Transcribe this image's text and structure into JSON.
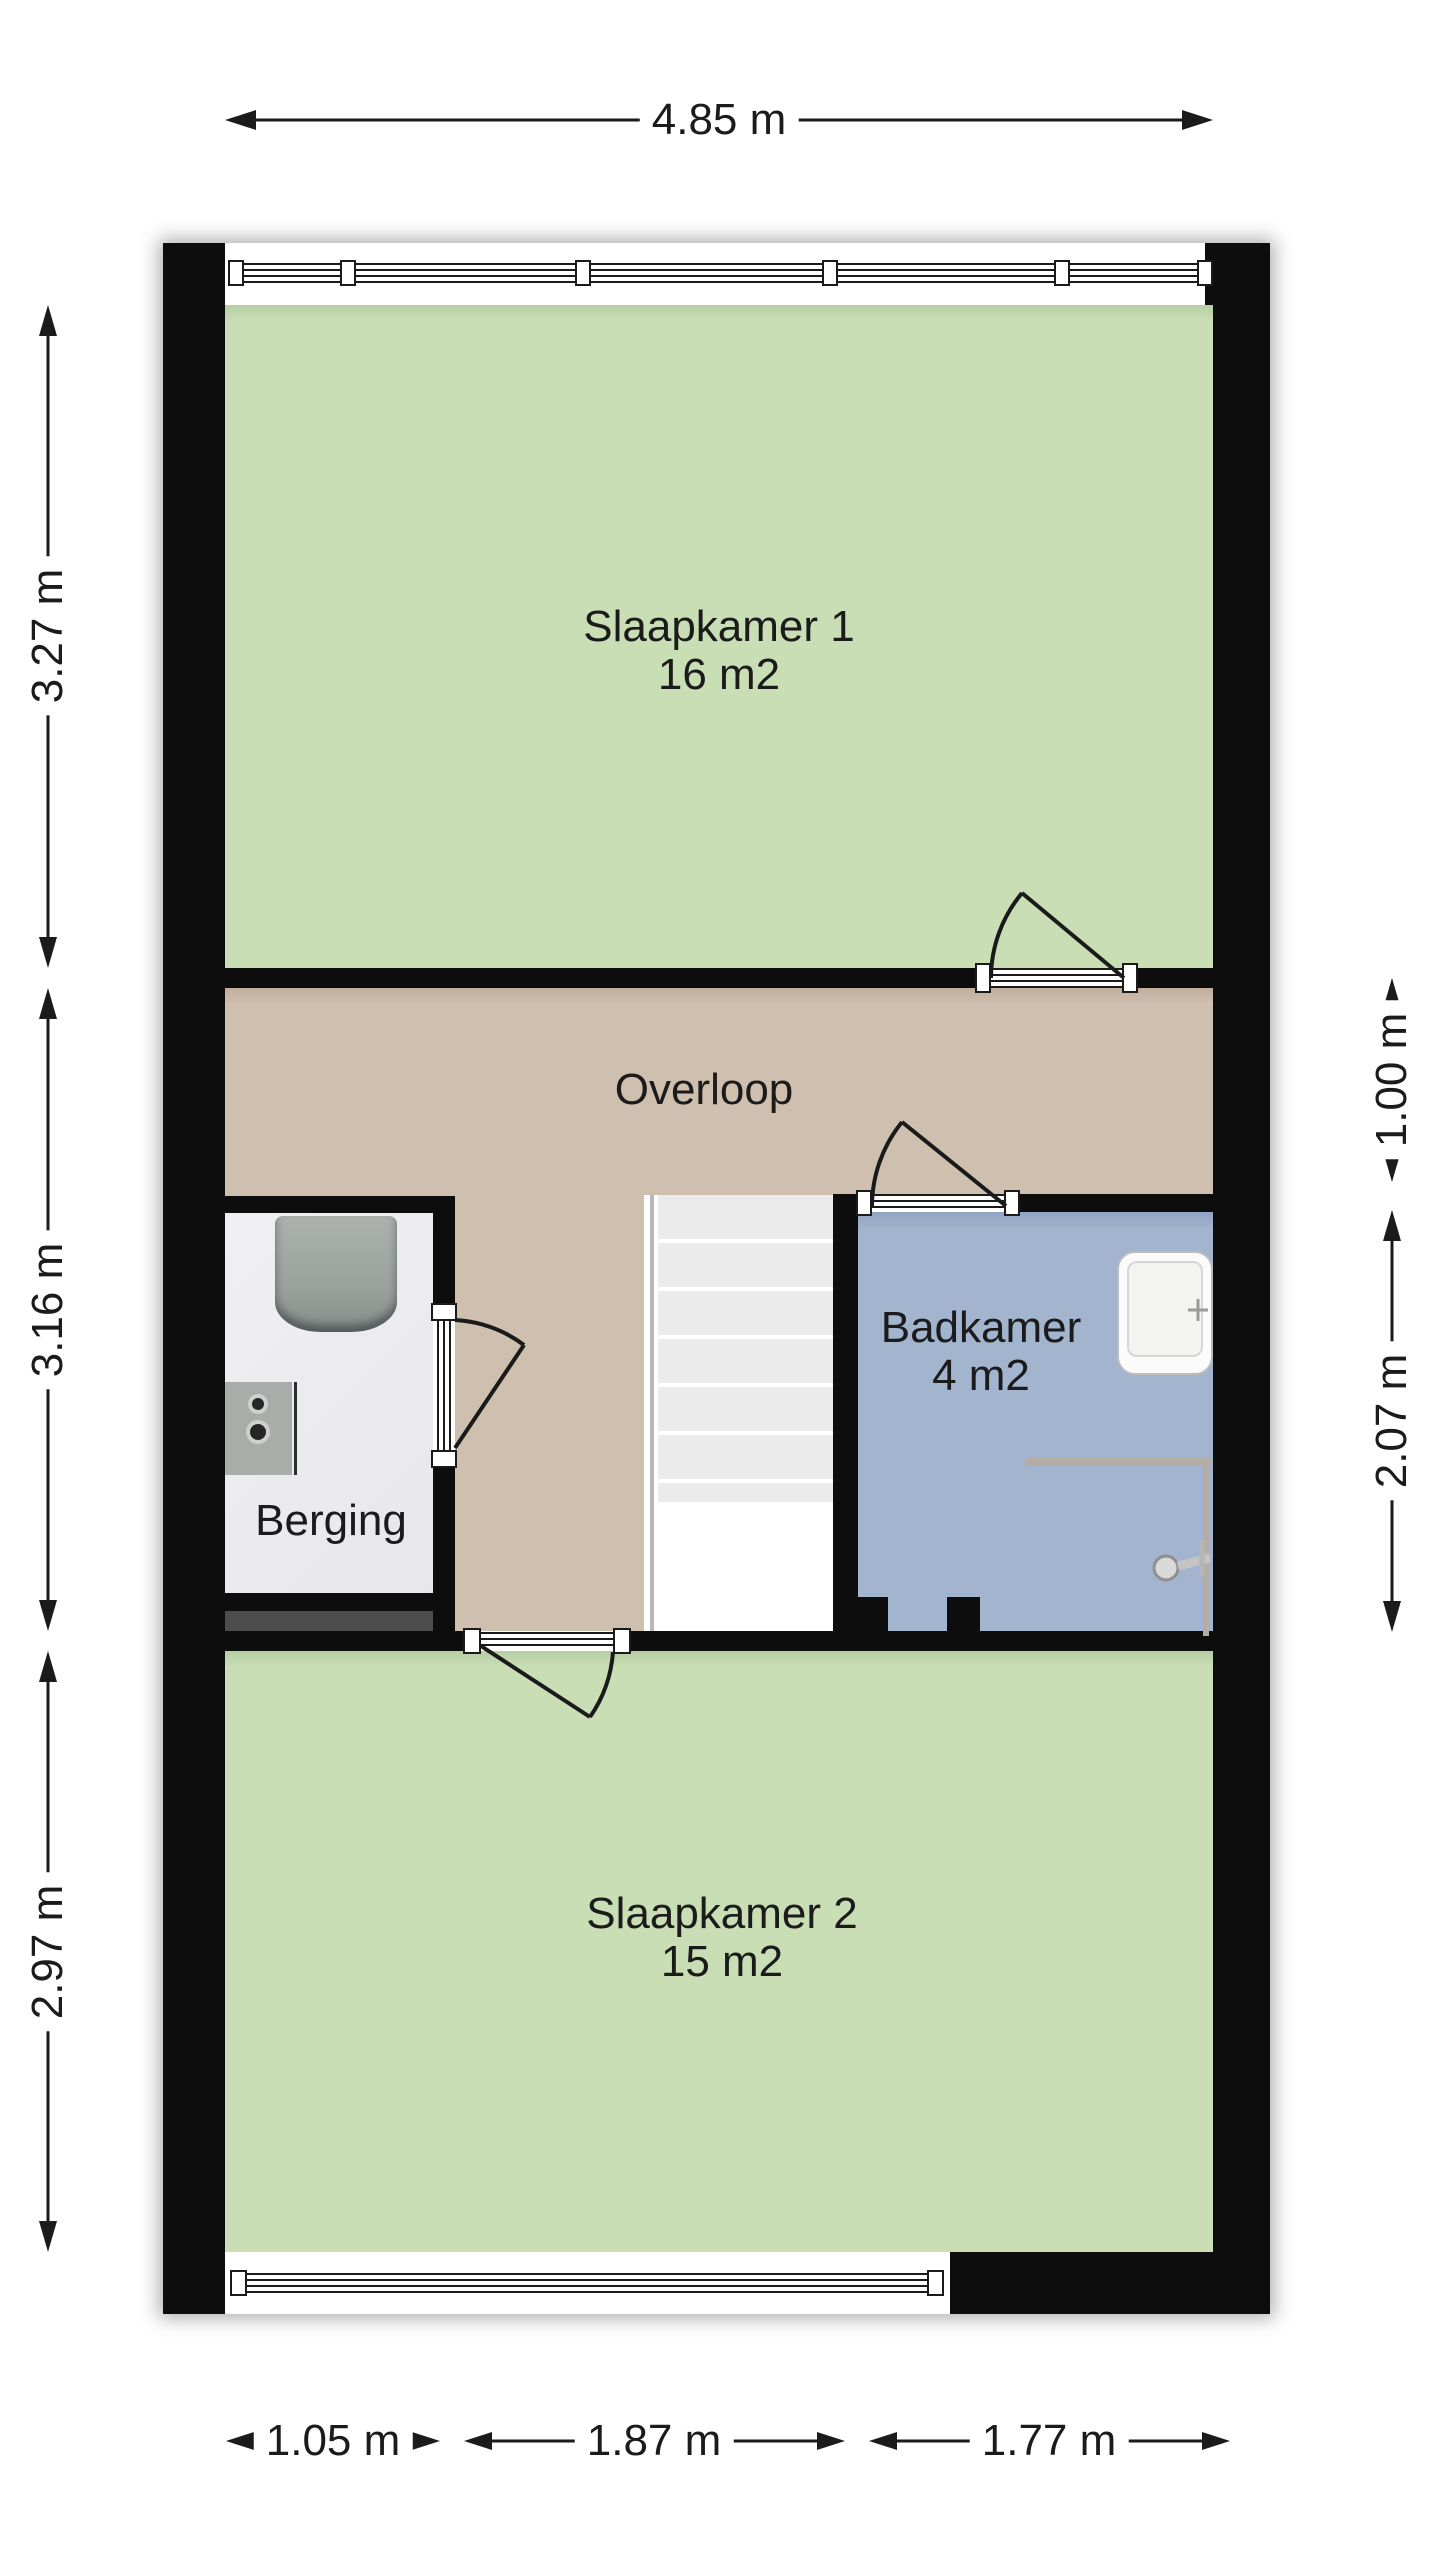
{
  "rooms": {
    "slaapkamer1": {
      "name": "Slaapkamer 1",
      "area": "16 m2"
    },
    "slaapkamer2": {
      "name": "Slaapkamer 2",
      "area": "15 m2"
    },
    "badkamer": {
      "name": "Badkamer",
      "area": "4 m2"
    },
    "overloop": {
      "name": "Overloop"
    },
    "berging": {
      "name": "Berging"
    }
  },
  "dimensions": {
    "top": "4.85 m",
    "bottom": [
      "1.05 m",
      "1.87 m",
      "1.77 m"
    ],
    "left": [
      "3.27 m",
      "3.16 m",
      "2.97 m"
    ],
    "right": [
      "1.00 m",
      "2.07 m"
    ]
  },
  "colors": {
    "wall": "#0d0d0d",
    "bedroom_floor": "#c9deb4",
    "hall_floor": "#cfbfae",
    "bathroom_floor": "#a3b4cf",
    "storage_floor": "#ebebed",
    "stair_tread": "#ebebeb",
    "fixture_gray": "#9ba19d",
    "text": "#1b1b1b"
  }
}
